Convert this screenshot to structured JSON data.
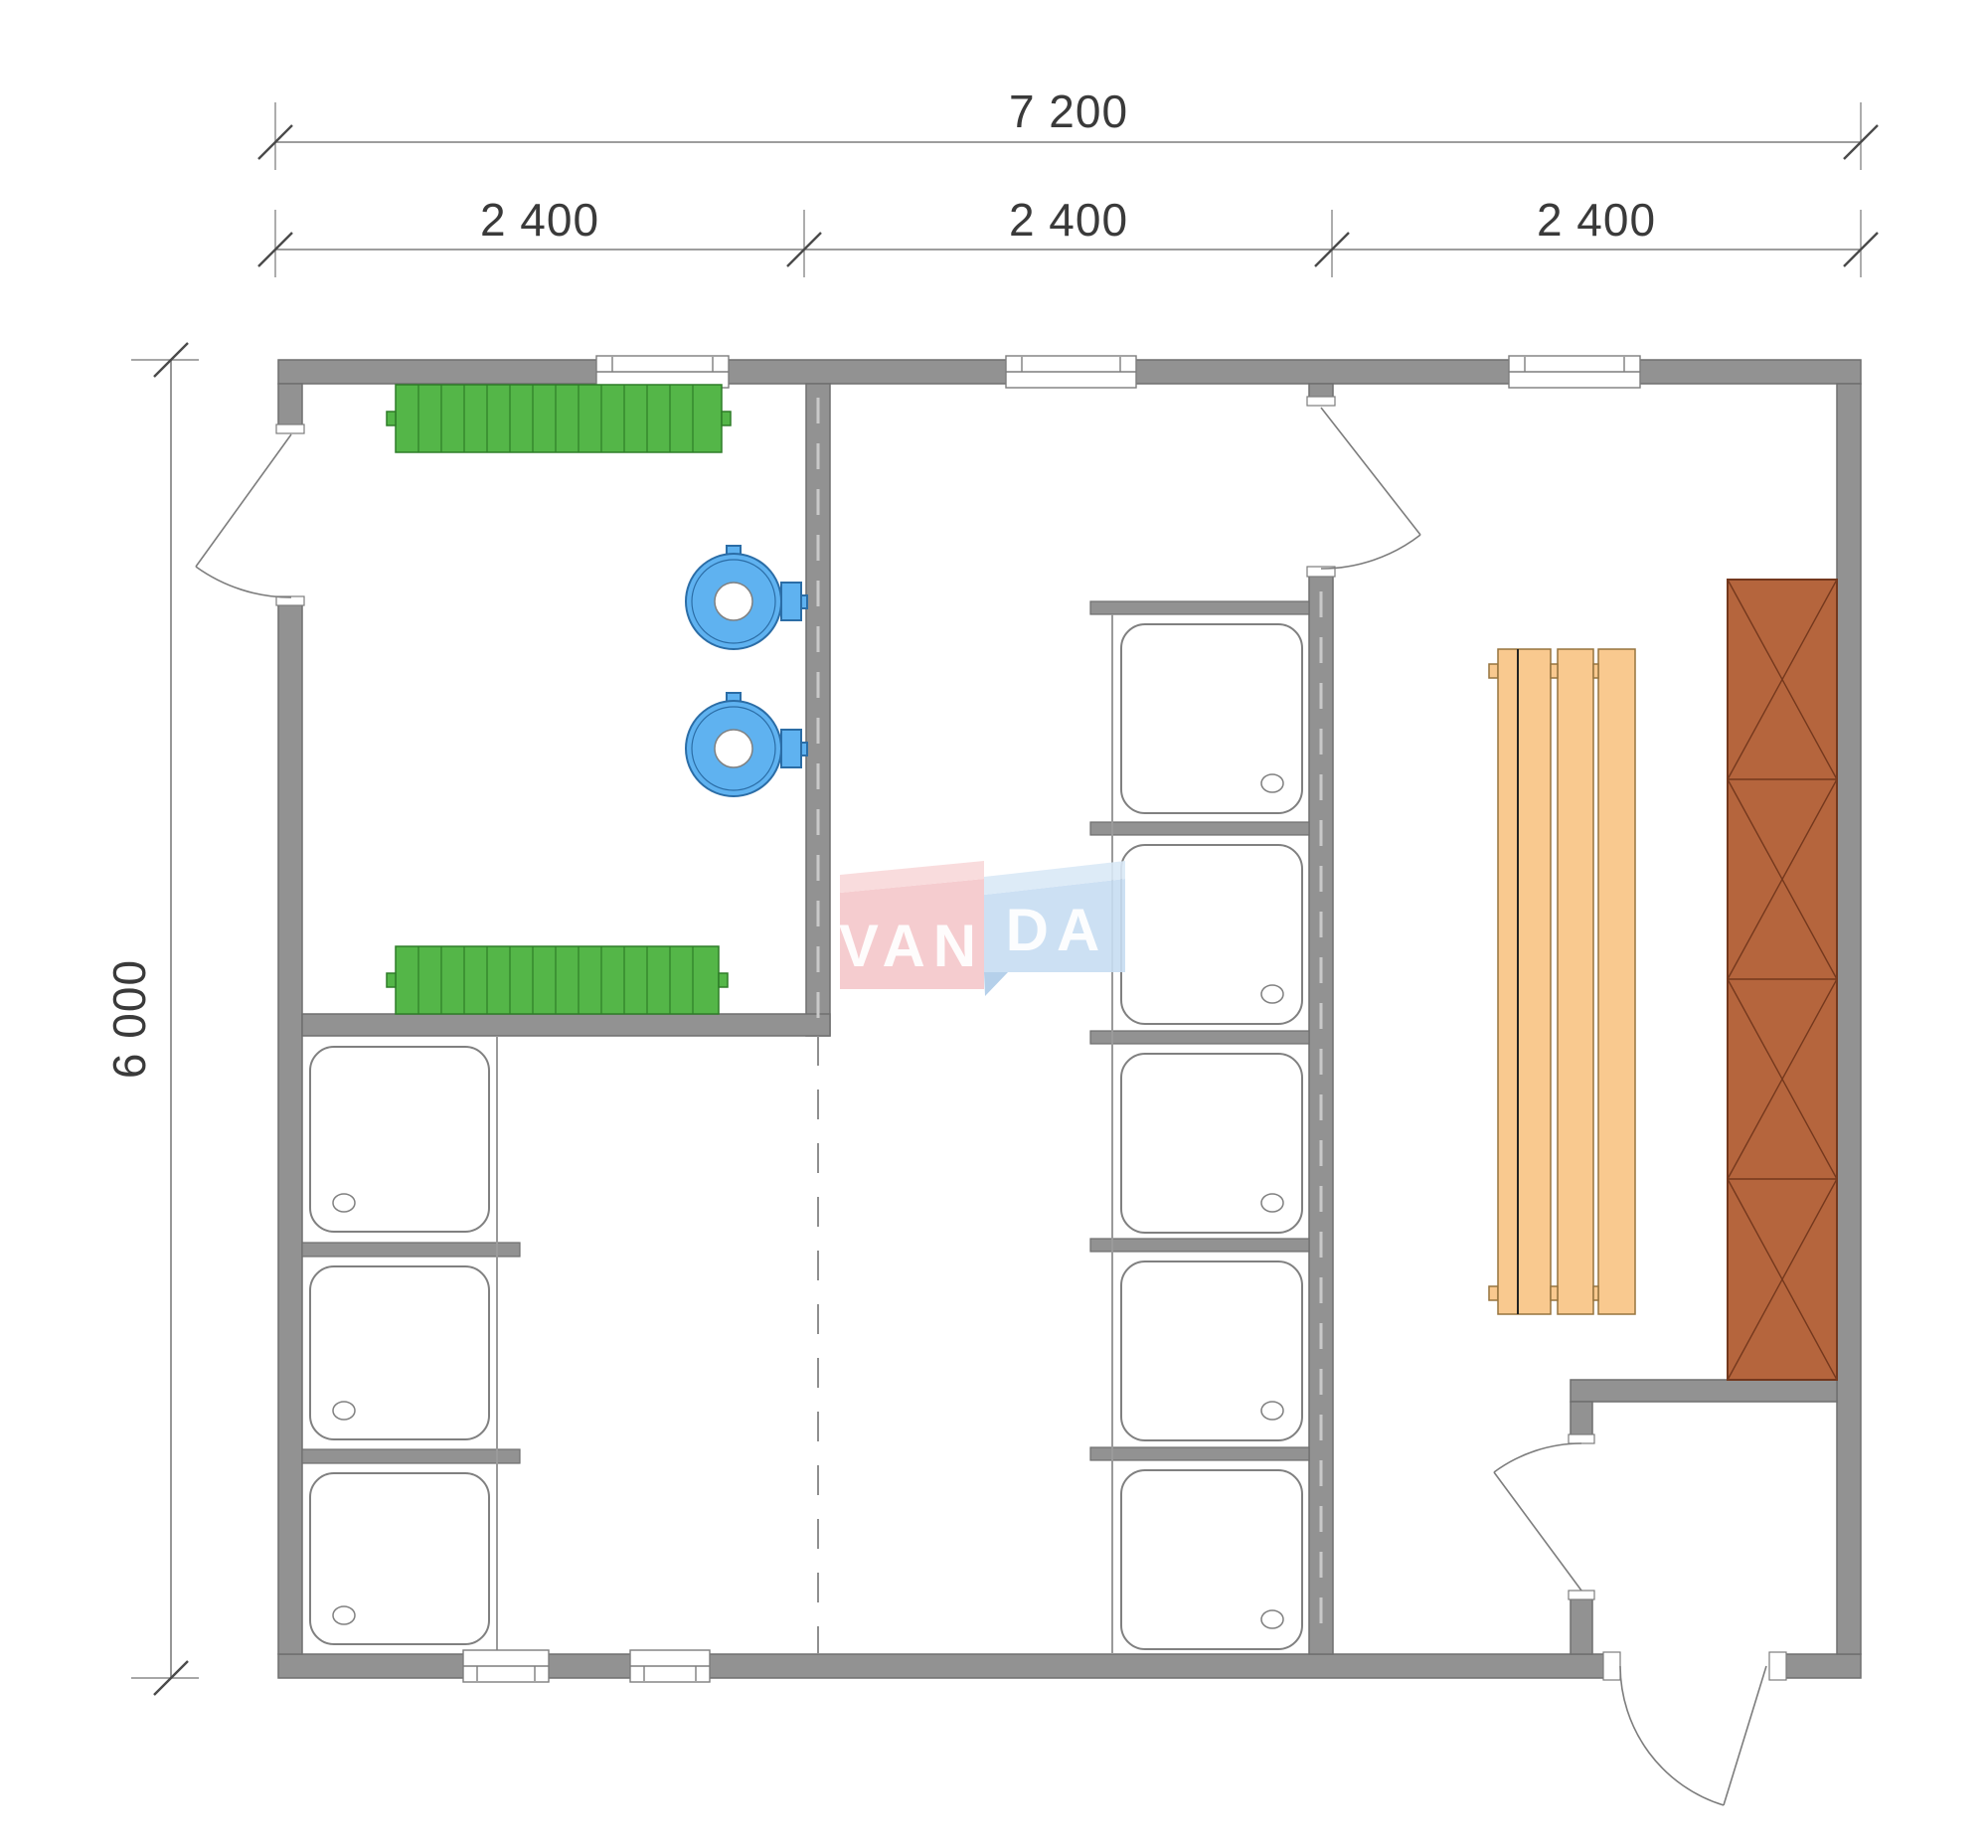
{
  "title": "Bath house floor plan 7200 x 6000",
  "dimensions": {
    "top_total": {
      "label": "7 200"
    },
    "top_segments": [
      {
        "label": "2 400"
      },
      {
        "label": "2 400"
      },
      {
        "label": "2 400"
      }
    ],
    "left_height": {
      "label": "6 000"
    }
  },
  "watermark": {
    "text_left": "VAN",
    "text_right": "DA"
  },
  "fixtures": {
    "radiators": 2,
    "shower_trays_left_column": 3,
    "shower_trays_middle_column": 5,
    "wall_mounted_water_heaters": 2,
    "sauna_benches": 1,
    "locker_cabinets": 1,
    "exterior_doors": 2,
    "interior_doors": 2,
    "windows_top_wall": 3,
    "windows_bottom_wall": 2
  },
  "colors": {
    "wall-fill": "#929292",
    "wall-edge": "#6f6f6f",
    "line": "#7d7d7d",
    "tray-edge": "#808080",
    "radiator-green": "#54B648",
    "radiator-edge": "#2E7D28",
    "fixture-blue": "#5FB2F0",
    "fixture-blue-edge": "#2B6DA6",
    "bench-fill": "#F9C98F",
    "bench-edge": "#96743F",
    "cabinet-fill": "#B5653D",
    "cabinet-edge": "#74381D",
    "watermark-pink": "#F5C7CA",
    "watermark-pink-light": "#F9D9DA",
    "watermark-blue": "#C7DDF2",
    "watermark-blue-light": "#DAE9F7",
    "watermark-fold": "#AECBE8",
    "dim-text": "#3A3A3A"
  }
}
